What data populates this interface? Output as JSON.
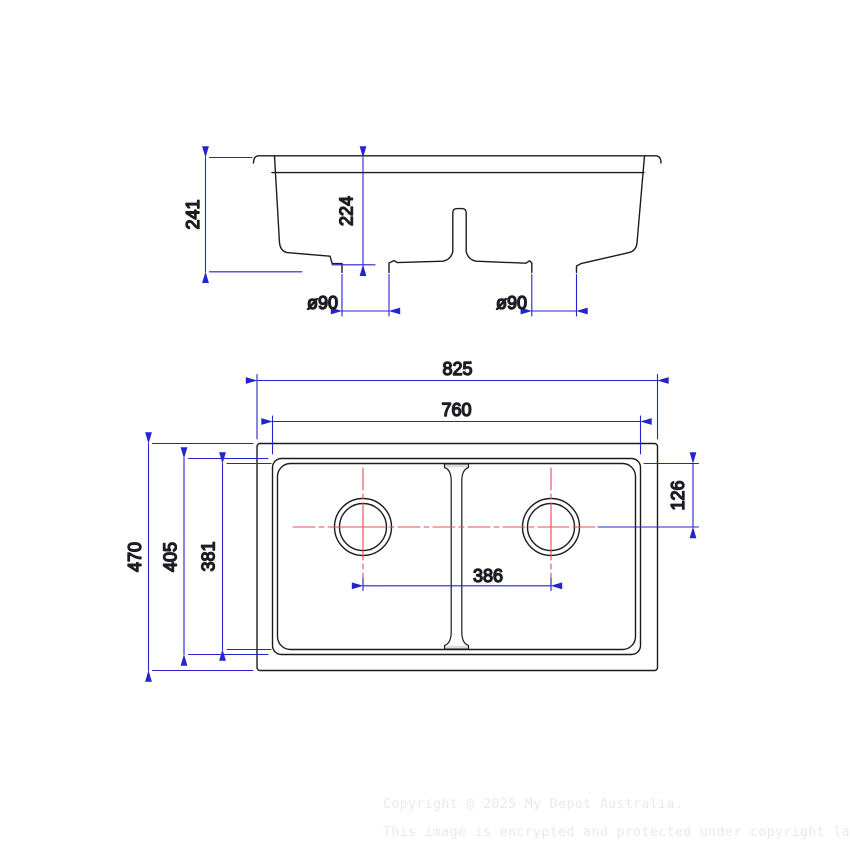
{
  "drawing": {
    "type": "sink-technical-drawing",
    "views": {
      "elevation": {
        "title": "front-section-view",
        "dimensions": {
          "overall_height": "241",
          "bowl_depth": "224",
          "left_drain_diameter": "ø90",
          "right_drain_diameter": "ø90"
        }
      },
      "plan": {
        "title": "top-view",
        "dimensions": {
          "overall_width": "825",
          "bowl_width": "760",
          "overall_depth": "470",
          "bowl_depth_outer": "405",
          "bowl_depth_inner": "381",
          "drain_spacing": "386",
          "drain_center_offset": "126"
        }
      }
    },
    "colors": {
      "outline": "#1c1c1c",
      "dimension_blue": "#2424cc",
      "centerline_red": "#e25050",
      "watermark_gray": "#e9e9e9"
    }
  },
  "watermark": {
    "line1": "Copyright @ 2025 My Depot Australia.",
    "line2": "This image is encrypted and protected under copyright law."
  }
}
